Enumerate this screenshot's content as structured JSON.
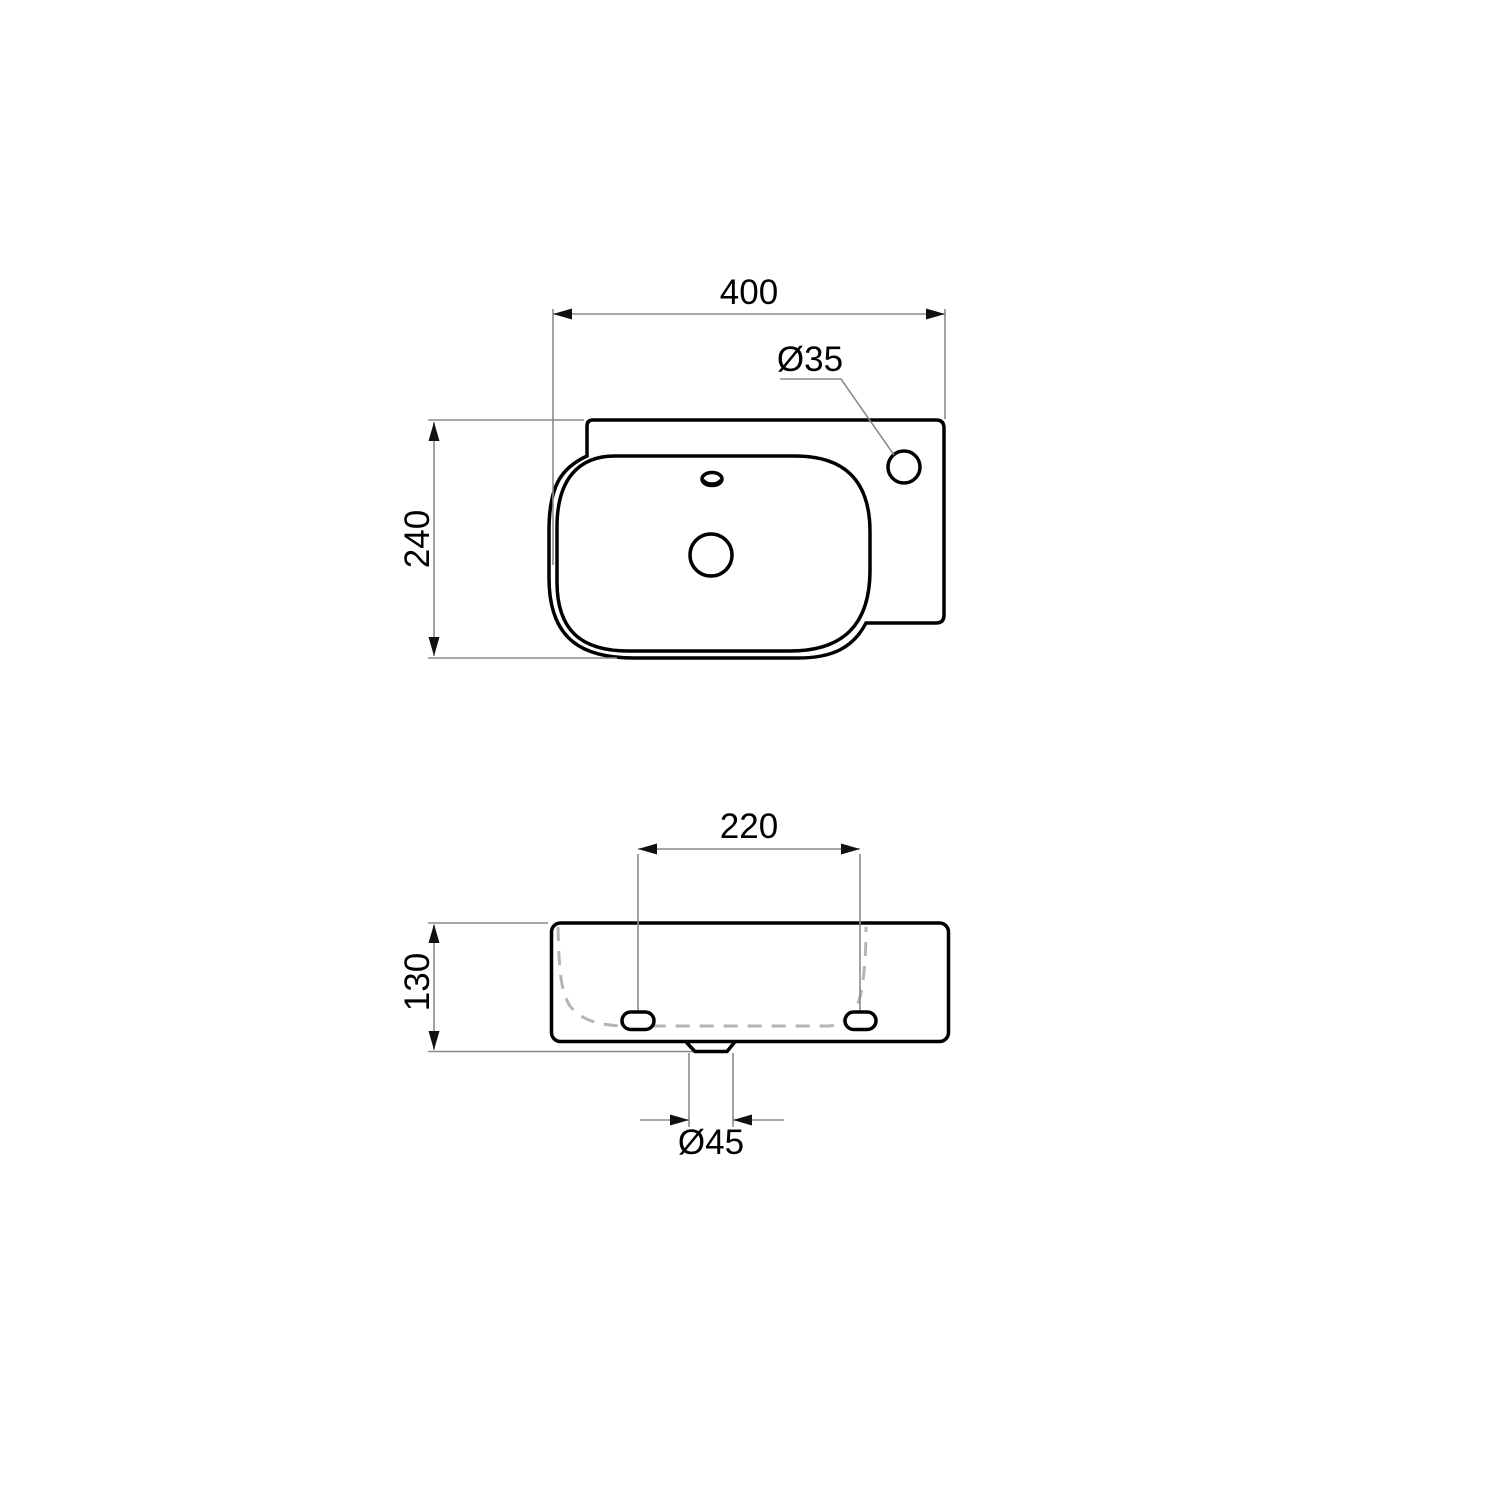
{
  "page": {
    "background": "#ffffff"
  },
  "drawing": {
    "kind": "dimensioned technical drawing of a wall-hung washbasin (top view and front view)",
    "colors": {
      "object_line": "#000000",
      "dimension_line": "#8a8a8a",
      "hidden_line": "#b5b5b5",
      "arrowhead": "#111111",
      "text": "#000000",
      "background": "#ffffff"
    },
    "top_view": {
      "width_label": "400",
      "width_value": 400,
      "depth_label": "240",
      "depth_value": 240,
      "tap_hole_label": "Ø35",
      "tap_hole_value": 35
    },
    "front_view": {
      "hole_spacing_label": "220",
      "hole_spacing_value": 220,
      "height_label": "130",
      "height_value": 130,
      "drain_label": "Ø45",
      "drain_value": 45
    }
  }
}
